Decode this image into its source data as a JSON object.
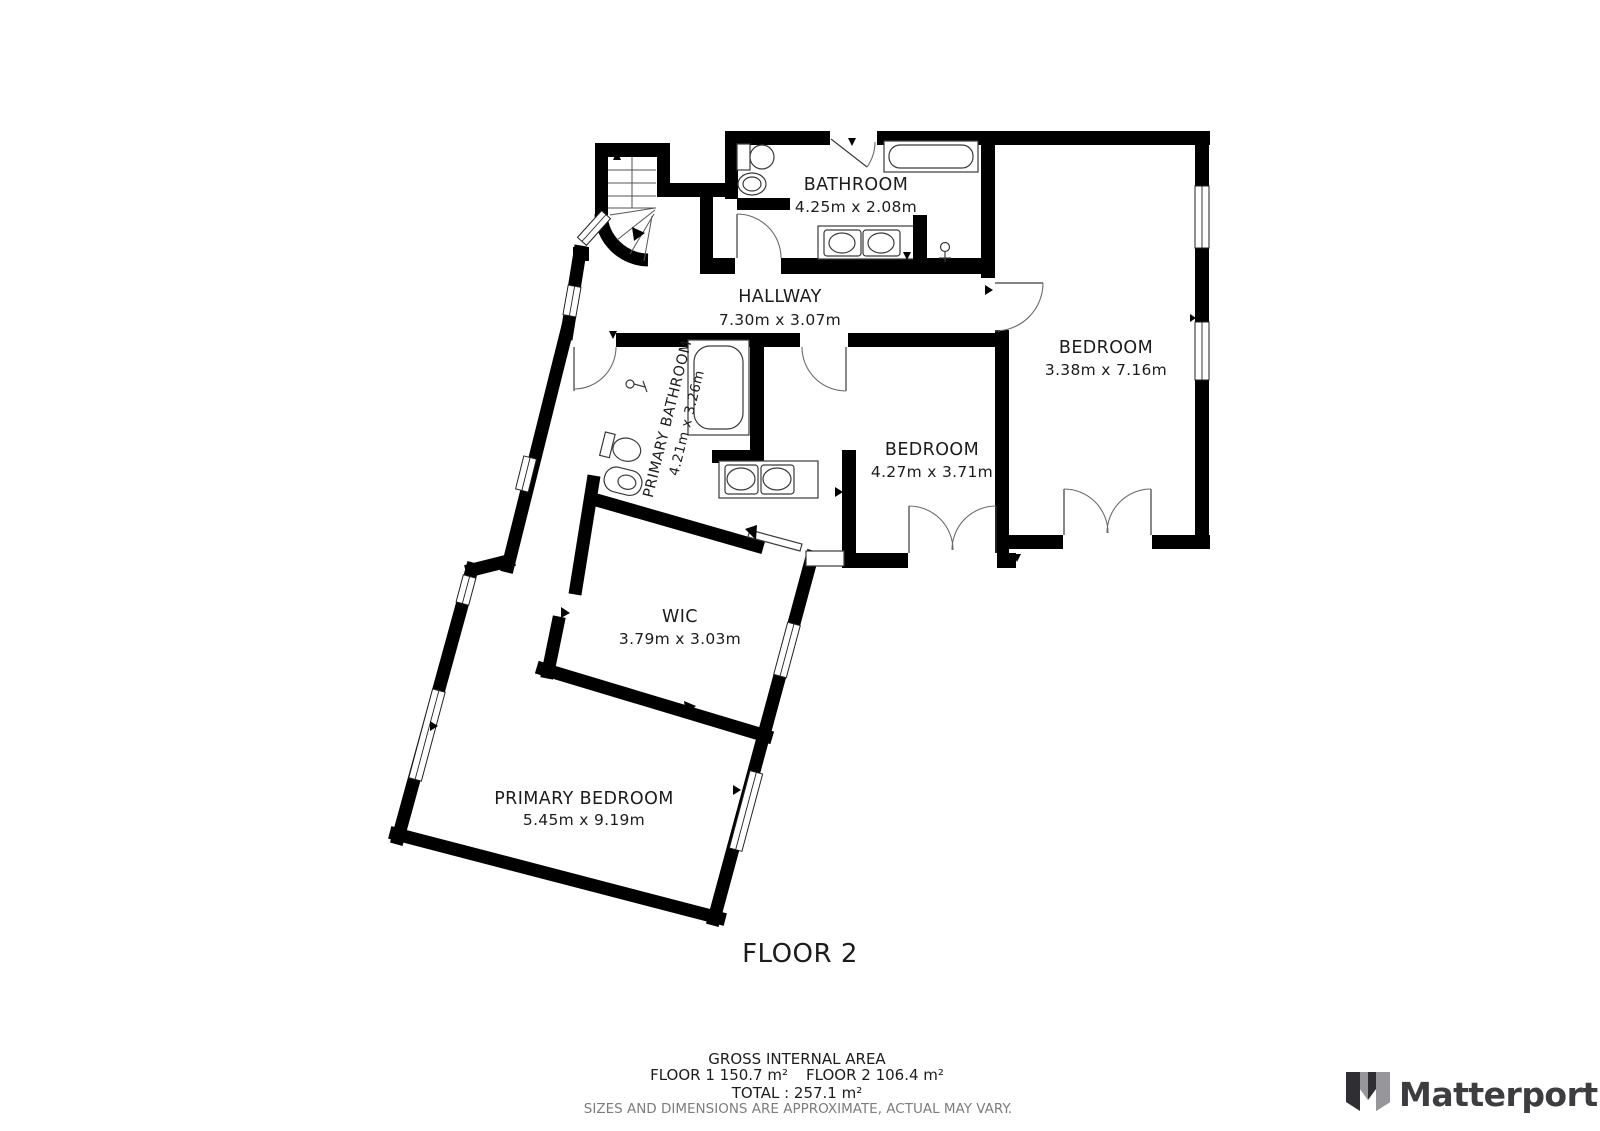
{
  "floor_plan": {
    "floor_label": "FLOOR 2",
    "rooms": [
      {
        "id": "bathroom",
        "name": "BATHROOM",
        "dims": "4.25m x 2.08m"
      },
      {
        "id": "hallway",
        "name": "HALLWAY",
        "dims": "7.30m x 3.07m"
      },
      {
        "id": "bedroom-right",
        "name": "BEDROOM",
        "dims": "3.38m x 7.16m"
      },
      {
        "id": "primary-bathroom",
        "name": "PRIMARY BATHROOM",
        "dims": "4.21m x 3.26m"
      },
      {
        "id": "bedroom-middle",
        "name": "BEDROOM",
        "dims": "4.27m x 3.71m"
      },
      {
        "id": "wic",
        "name": "WIC",
        "dims": "3.79m x 3.03m"
      },
      {
        "id": "primary-bedroom",
        "name": "PRIMARY BEDROOM",
        "dims": "5.45m x 9.19m"
      }
    ]
  },
  "footer": {
    "gross_internal_area_label": "GROSS INTERNAL AREA",
    "floor1_area": "FLOOR 1 150.7 m²",
    "floor2_area": "FLOOR 2 106.4 m²",
    "total": "TOTAL :  257.1 m²",
    "disclaimer": "SIZES AND DIMENSIONS ARE APPROXIMATE, ACTUAL MAY VARY."
  },
  "branding": {
    "logo_text": "Matterport"
  },
  "colors": {
    "wall": "#000000",
    "fixture_stroke": "#3a3a3a",
    "label_text": "#1c1c1c",
    "muted_text": "#7d7d7d",
    "logo_dark": "#3c3c41",
    "logo_gray": "#97979b"
  }
}
